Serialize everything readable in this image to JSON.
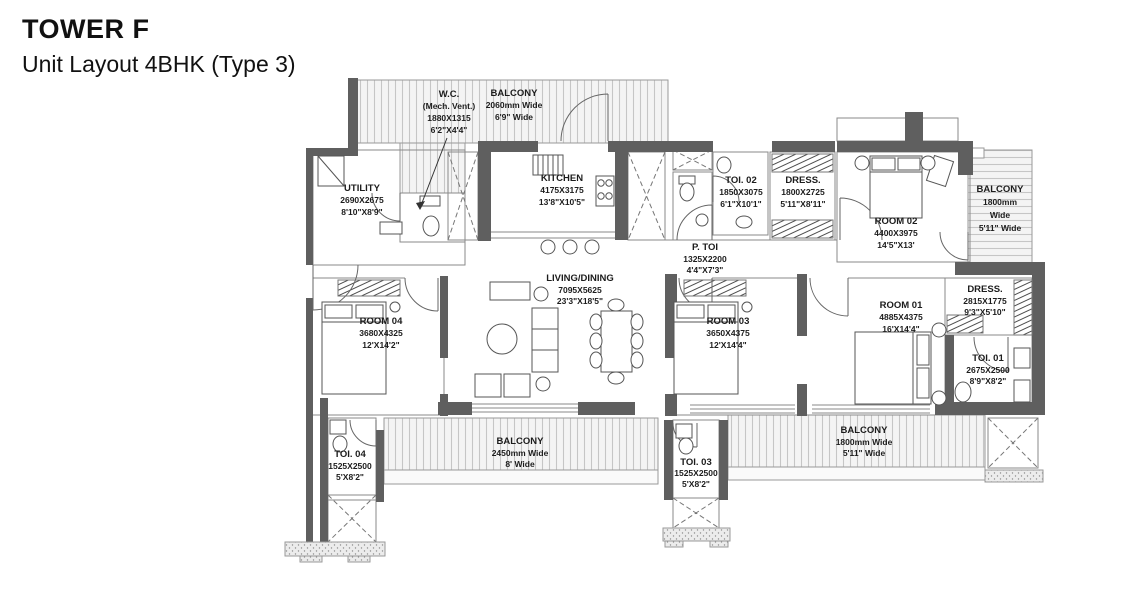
{
  "header": {
    "title": "TOWER F",
    "subtitle": "Unit Layout 4BHK (Type 3)"
  },
  "rooms": {
    "wc": {
      "lines": [
        "W.C.",
        "(Mech. Vent.)",
        "1880X1315",
        "6'2\"X4'4\""
      ]
    },
    "balcony_top": {
      "lines": [
        "BALCONY",
        "2060mm Wide",
        "6'9\" Wide"
      ]
    },
    "kitchen": {
      "lines": [
        "KITCHEN",
        "4175X3175",
        "13'8\"X10'5\""
      ]
    },
    "utility": {
      "lines": [
        "UTILITY",
        "2690X2675",
        "8'10\"X8'9\""
      ]
    },
    "toi02": {
      "lines": [
        "TOI. 02",
        "1850X3075",
        "6'1\"X10'1\""
      ]
    },
    "dress02": {
      "lines": [
        "DRESS.",
        "1800X2725",
        "5'11\"X8'11\""
      ]
    },
    "room02": {
      "lines": [
        "ROOM 02",
        "4400X3975",
        "14'5\"X13'"
      ]
    },
    "balcony_right": {
      "lines": [
        "BALCONY",
        "1800mm",
        "Wide",
        "5'11\" Wide"
      ]
    },
    "ptoi": {
      "lines": [
        "P. TOI",
        "1325X2200",
        "4'4\"X7'3\""
      ]
    },
    "living": {
      "lines": [
        "LIVING/DINING",
        "7095X5625",
        "23'3\"X18'5\""
      ]
    },
    "room04": {
      "lines": [
        "ROOM 04",
        "3680X4325",
        "12'X14'2\""
      ]
    },
    "room03": {
      "lines": [
        "ROOM 03",
        "3650X4375",
        "12'X14'4\""
      ]
    },
    "room01": {
      "lines": [
        "ROOM 01",
        "4885X4375",
        "16'X14'4\""
      ]
    },
    "dress01": {
      "lines": [
        "DRESS.",
        "2815X1775",
        "9'3\"X5'10\""
      ]
    },
    "toi01": {
      "lines": [
        "TOI. 01",
        "2675X2500",
        "8'9\"X8'2\""
      ]
    },
    "toi04": {
      "lines": [
        "TOI. 04",
        "1525X2500",
        "5'X8'2\""
      ]
    },
    "balcony_bl": {
      "lines": [
        "BALCONY",
        "2450mm Wide",
        "8' Wide"
      ]
    },
    "toi03": {
      "lines": [
        "TOI. 03",
        "1525X2500",
        "5'X8'2\""
      ]
    },
    "balcony_br": {
      "lines": [
        "BALCONY",
        "1800mm Wide",
        "5'11\" Wide"
      ]
    }
  },
  "colors": {
    "wall": "#5f5f5f",
    "thin_line": "#8a8a8a",
    "hatch": "#c6c6c6",
    "text": "#1c1c1c"
  }
}
